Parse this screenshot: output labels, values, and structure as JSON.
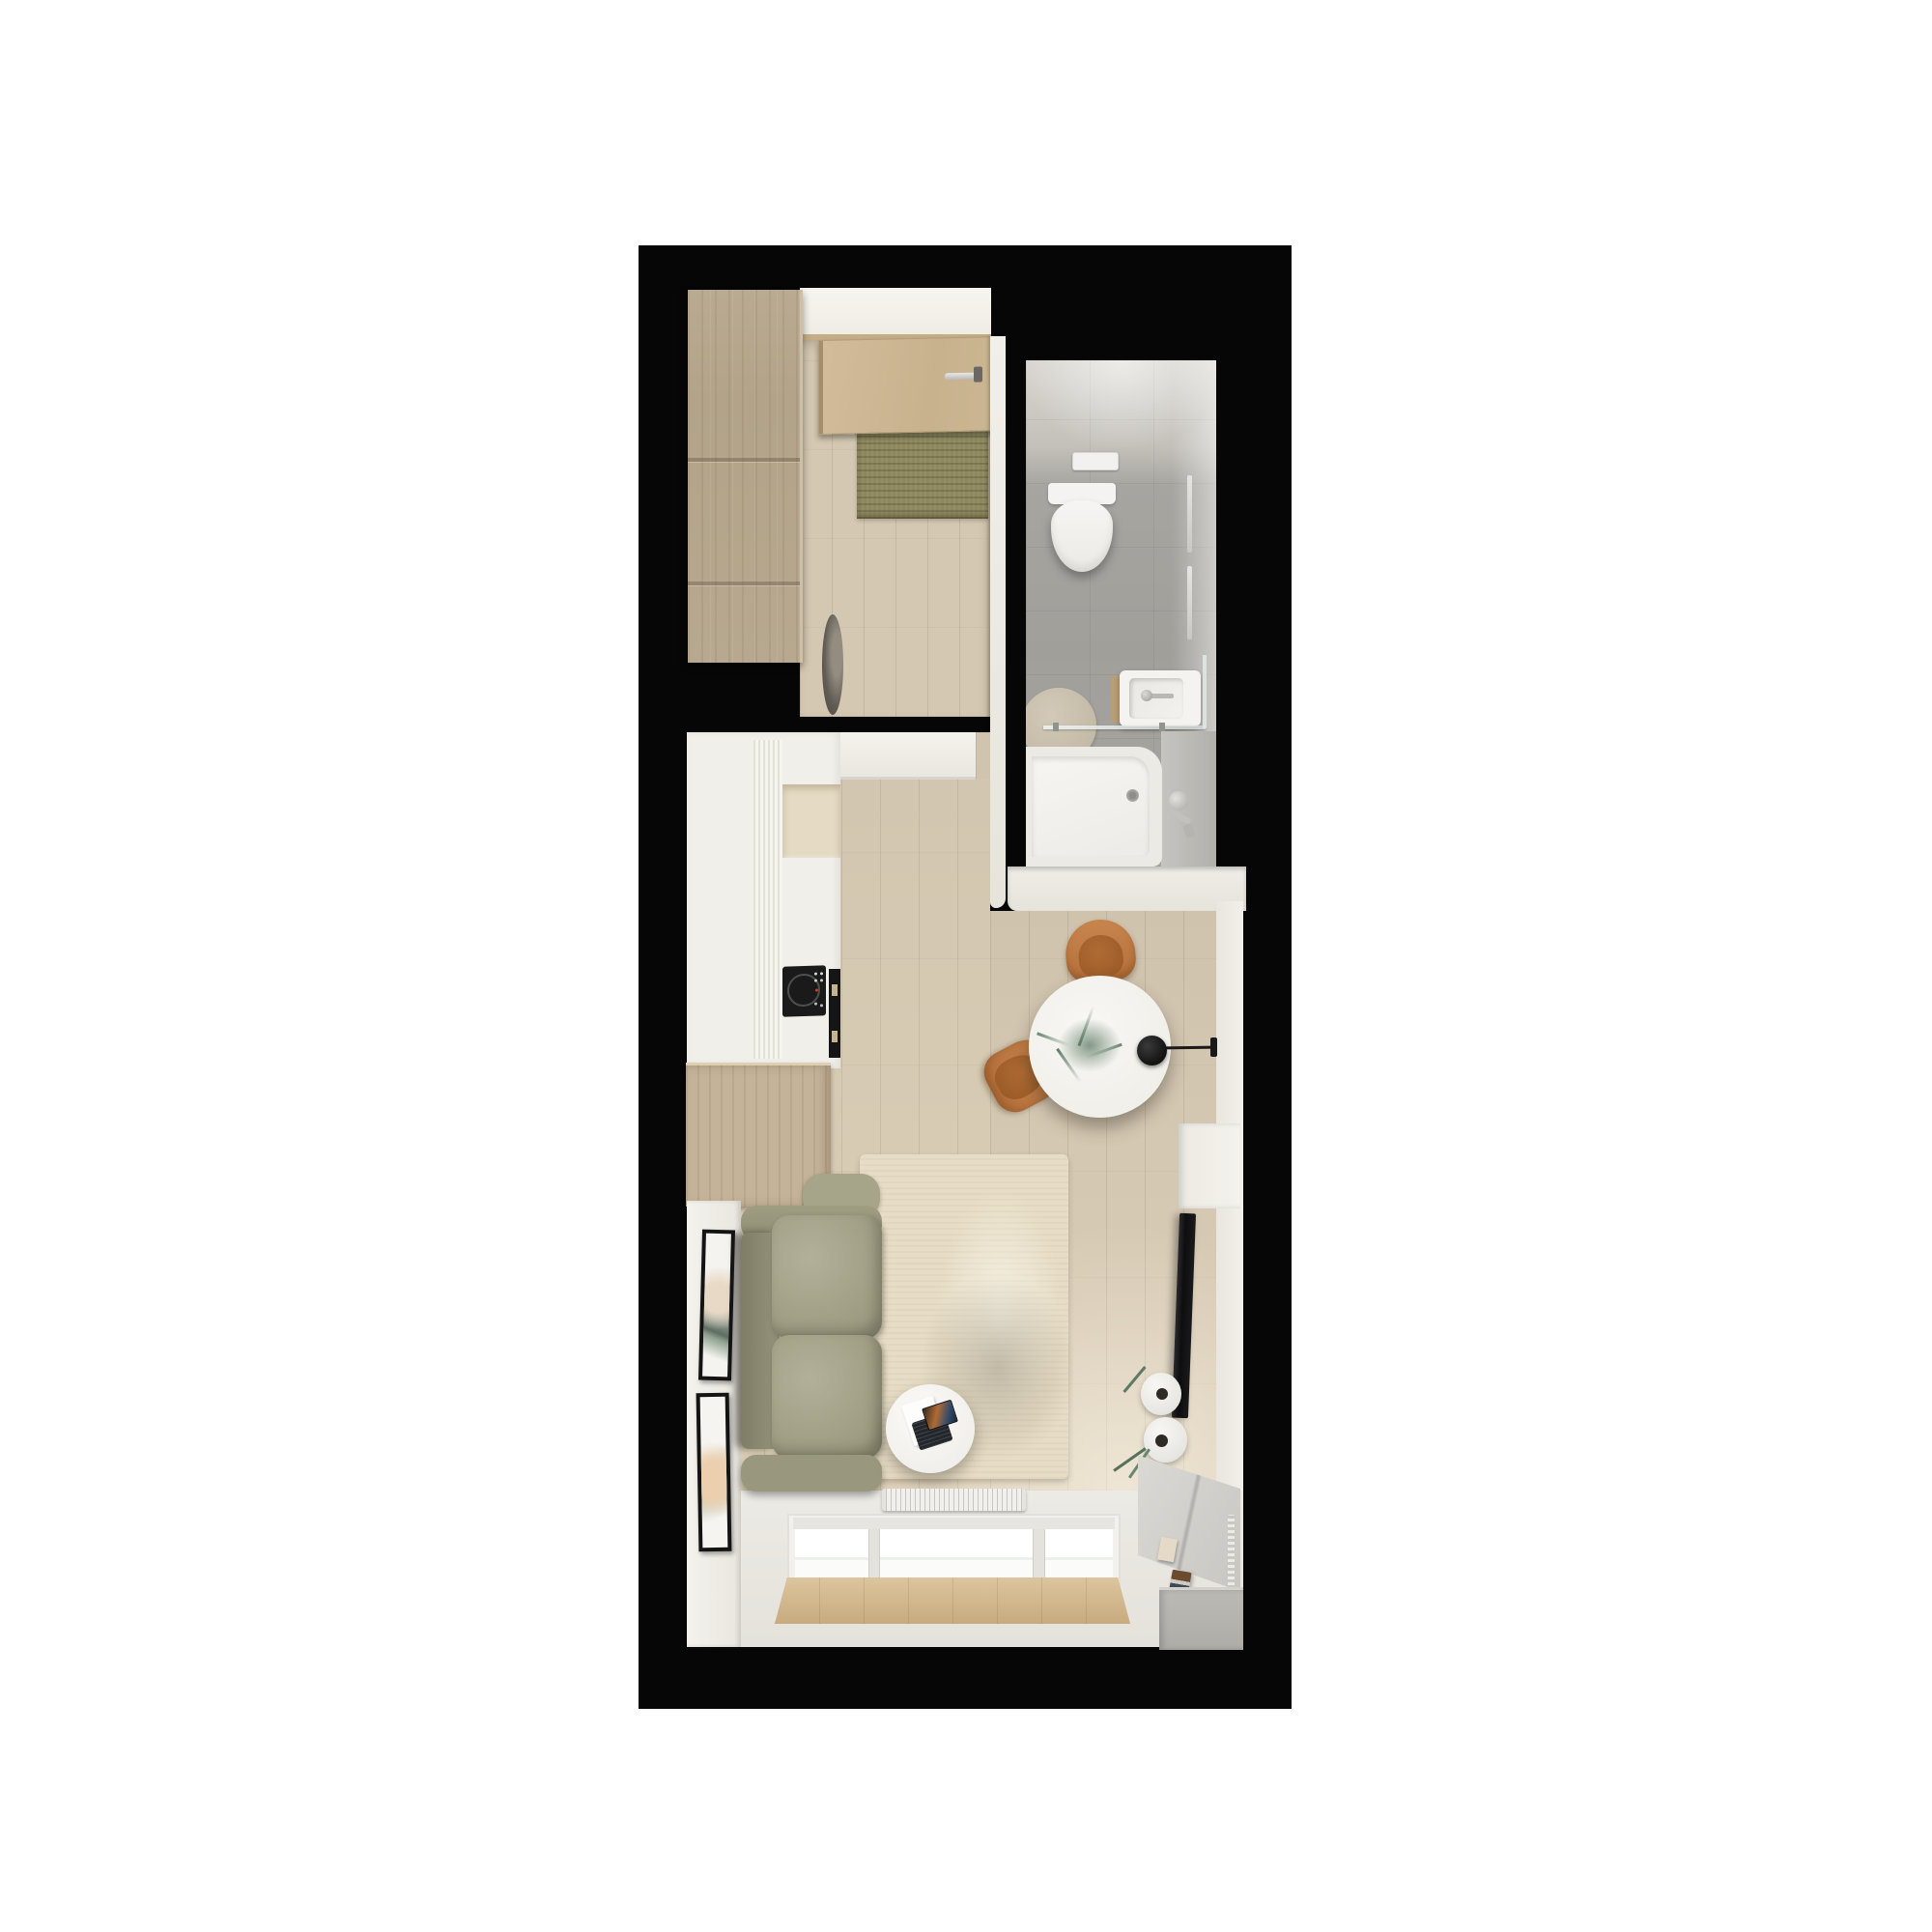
{
  "meta": {
    "title": "Top-down 3D render floor plan of a studio apartment on black background"
  },
  "palette": {
    "background": "#ffffff",
    "card_black": "#060606",
    "floor_wood": "#d5c9b3",
    "wardrobe_wood": "#b5a68d",
    "door_wood": "#cdb694",
    "doormat_olive": "#8b855c",
    "bathroom_tile": "#a3a19c",
    "fixture_white": "#f3f2ee",
    "wall_white": "#efede7",
    "sofa_olive": "#a5a38c",
    "rug_cream": "#e8dfc9",
    "chair_cognac": "#bf7c44",
    "cooktop_black": "#1a1a1a",
    "tv_black": "#131313",
    "plant_green": "#5d7a64",
    "sill_wood": "#d2b98f",
    "console_gray": "#d6d4cf"
  },
  "rooms": [
    {
      "name": "Entry hall",
      "objects": [
        "wardrobe",
        "entry door",
        "door handle",
        "doormat",
        "floor vase"
      ]
    },
    {
      "name": "Bathroom",
      "objects": [
        "flush plate",
        "wall-hung toilet",
        "towel rails",
        "round rug",
        "washbasin",
        "faucet",
        "glass shower screen",
        "bathtub",
        "bath mixer"
      ]
    },
    {
      "name": "Kitchen",
      "objects": [
        "tall cabinets",
        "fluted panel",
        "counter niche",
        "induction cooktop",
        "utensil rail",
        "wood base cabinet"
      ]
    },
    {
      "name": "Dining nook",
      "objects": [
        "round table",
        "eucalyptus sprigs",
        "black wall lamp",
        "cognac chair",
        "cognac chair"
      ]
    },
    {
      "name": "Living room",
      "objects": [
        "picture frame",
        "picture frame",
        "olive sofa",
        "cream rug",
        "round coffee table",
        "laptop",
        "wall TV",
        "vases with eucalyptus",
        "sideboard",
        "books",
        "storage box",
        "radiator",
        "window",
        "window sill",
        "corner unit"
      ]
    }
  ]
}
